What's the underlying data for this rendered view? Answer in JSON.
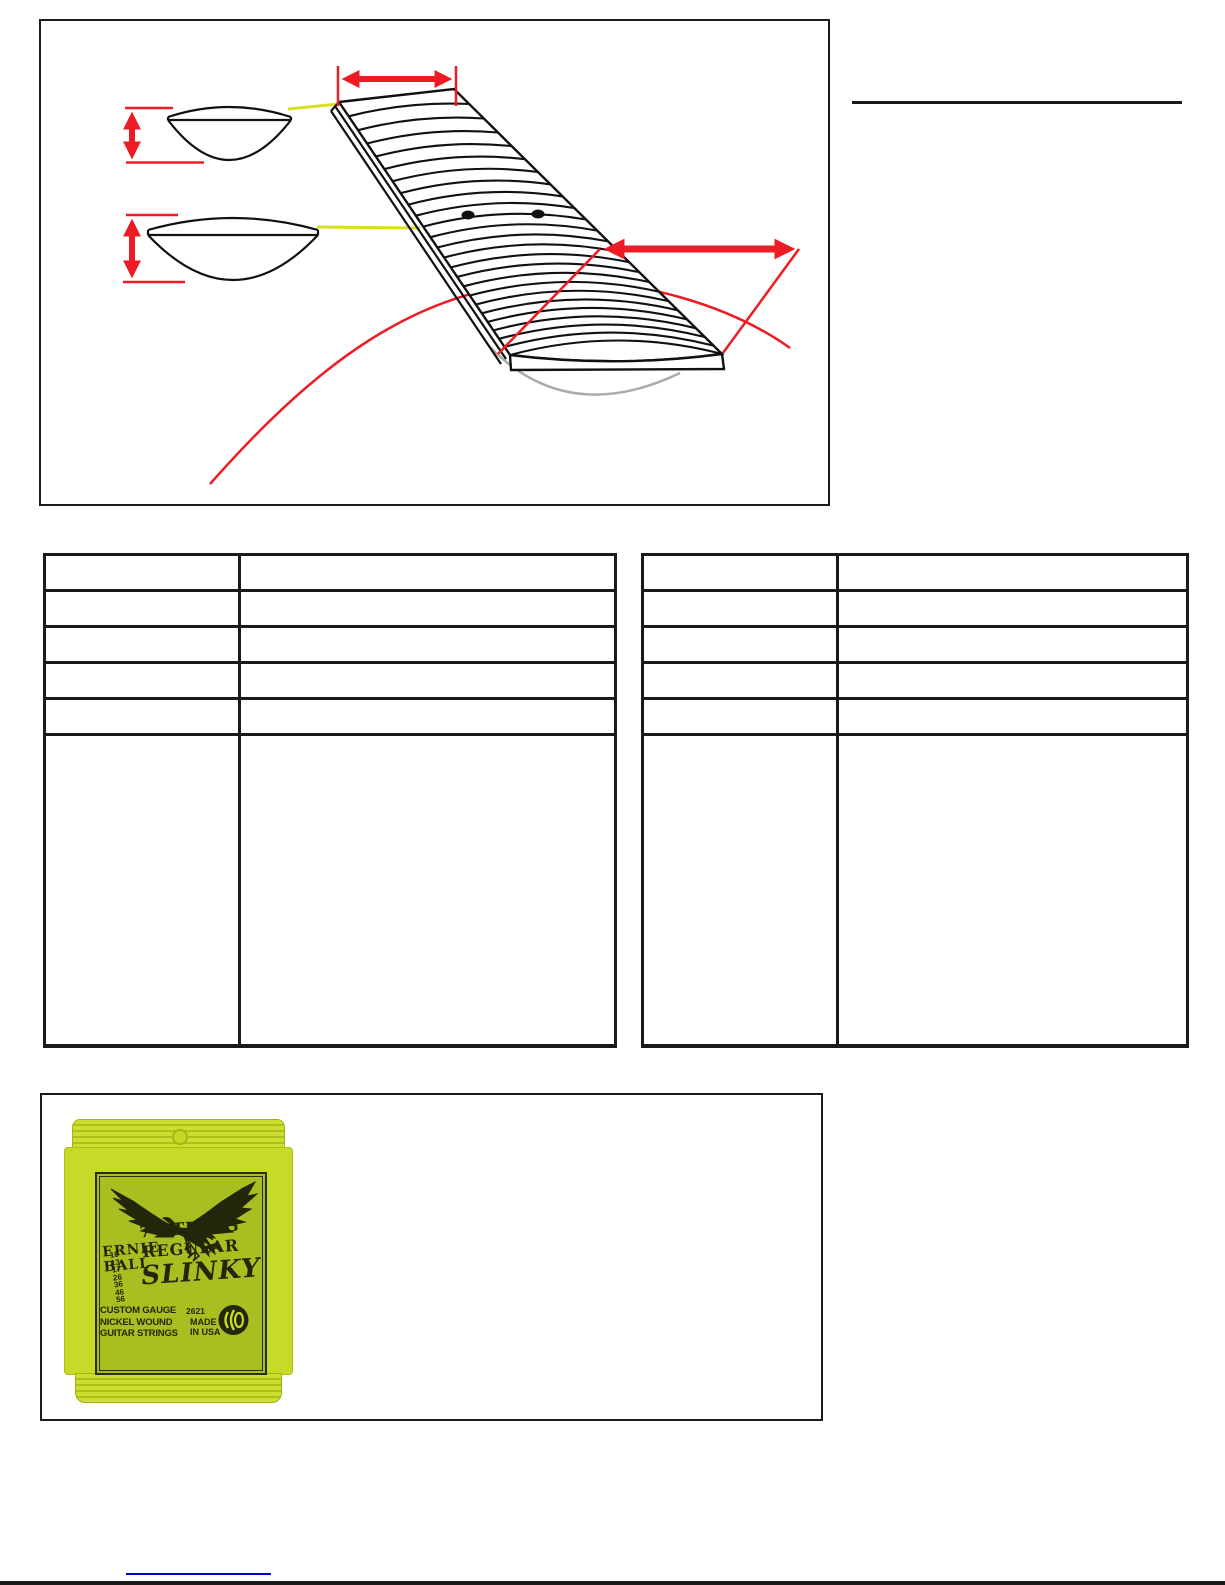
{
  "page": {
    "background": "#ffffff",
    "bottom_edge_color": "#1a1a1a"
  },
  "figure_neck_diagram": {
    "border_color": "#1a1a1a",
    "colors": {
      "measure_red": "#ed1c24",
      "pointer_yellow": "#d9e021",
      "radius_gray": "#ababab",
      "line_black": "#111111"
    },
    "elements": [
      "fretboard-perspective-view",
      "nut-width-arrow",
      "nut-cross-section",
      "heel-cross-section",
      "neck-thickness-arrows",
      "fretboard-radius-arrow",
      "radius-arc",
      "twelfth-fret-inlay-dots"
    ]
  },
  "section_rule": {
    "color": "#1a1a1a"
  },
  "spec_tables": {
    "left": {
      "columns": 2,
      "rows": [
        [
          "",
          ""
        ],
        [
          "",
          ""
        ],
        [
          "",
          ""
        ],
        [
          "",
          ""
        ],
        [
          "",
          ""
        ],
        [
          "",
          ""
        ]
      ]
    },
    "right": {
      "columns": 2,
      "rows": [
        [
          "",
          ""
        ],
        [
          "",
          ""
        ],
        [
          "",
          ""
        ],
        [
          "",
          ""
        ],
        [
          "",
          ""
        ],
        [
          "",
          ""
        ]
      ]
    }
  },
  "figure_strings": {
    "border_color": "#1a1a1a",
    "package": {
      "brand_line1": "ERNIE",
      "brand_line2": "BALL",
      "title_line1": "7-STRING",
      "title_line2": "REGULAR",
      "title_line3": "SLINKY",
      "gauges": [
        "10",
        "13",
        "17",
        "26",
        "36",
        "46",
        "56"
      ],
      "desc_line1": "CUSTOM GAUGE",
      "desc_line2": "NICKEL WOUND",
      "desc_line3": "GUITAR STRINGS",
      "model_number": "2621",
      "made_line1": "MADE",
      "made_line2": "IN USA",
      "colors": {
        "pack": "#c8da28",
        "crimp_stripe": "#adc01c",
        "panel": "#aabe22",
        "ink": "#23270a"
      }
    }
  },
  "footer_link": {
    "underline_color": "#0000cc"
  }
}
